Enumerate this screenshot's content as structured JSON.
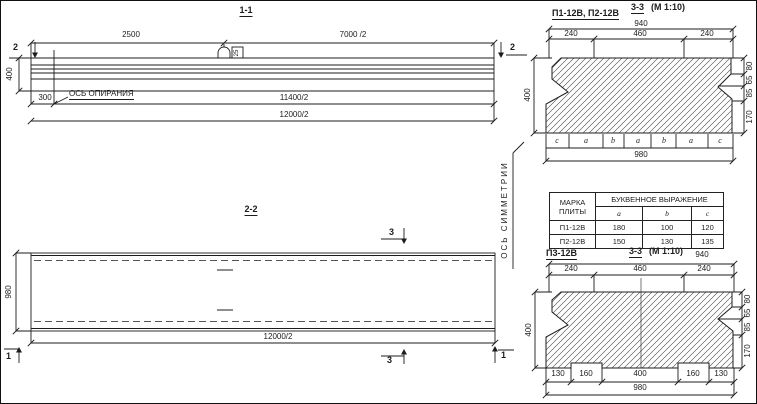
{
  "sections": {
    "s11": {
      "title": "1-1",
      "dim_top_left": "2500",
      "dim_top_right": "7000 /2",
      "cut_mark_left": "2",
      "cut_mark_right": "2",
      "dim_height": "400",
      "dim_support_offset": "300",
      "support_axis_label": "ОСЬ ОПИРАНИЯ",
      "dim_mid": "11400/2",
      "dim_bottom": "12000/2",
      "loop_label": "25"
    },
    "s22": {
      "title": "2-2",
      "cut_mark_3_top": "3",
      "cut_mark_3_bottom": "3",
      "cut_mark_1_left": "1",
      "cut_mark_1_right": "1",
      "dim_width": "980",
      "dim_bottom": "12000/2",
      "symmetry_axis_label": "ОСЬ СИММЕТРИИ"
    },
    "s33a": {
      "plate_label": "П1-12В, П2-12В",
      "title": "3-3",
      "scale": "(М 1:10)",
      "dim_overall_top": "940",
      "dims_top": [
        "240",
        "460",
        "240"
      ],
      "dim_height": "400",
      "dims_right": [
        "80",
        "65",
        "85",
        "170"
      ],
      "letter_dims": [
        "c",
        "a",
        "b",
        "a",
        "b",
        "a",
        "c"
      ],
      "dim_overall_bottom": "980"
    },
    "table": {
      "col1_header": "МАРКА ПЛИТЫ",
      "span_header": "БУКВЕННОЕ ВЫРАЖЕНИЕ",
      "letter_cols": [
        "a",
        "b",
        "c"
      ],
      "rows": [
        {
          "mark": "П1-12В",
          "a": "180",
          "b": "100",
          "c": "120"
        },
        {
          "mark": "П2-12В",
          "a": "150",
          "b": "130",
          "c": "135"
        }
      ]
    },
    "s33b": {
      "plate_label": "П3-12В",
      "title": "3-3",
      "scale": "(М 1:10)",
      "dim_overall_top": "940",
      "dims_top": [
        "240",
        "460",
        "240"
      ],
      "dim_height": "400",
      "dims_right": [
        "80",
        "65",
        "85",
        "170"
      ],
      "dims_bottom": [
        "130",
        "160",
        "400",
        "160",
        "130"
      ],
      "dim_overall_bottom": "980"
    }
  }
}
